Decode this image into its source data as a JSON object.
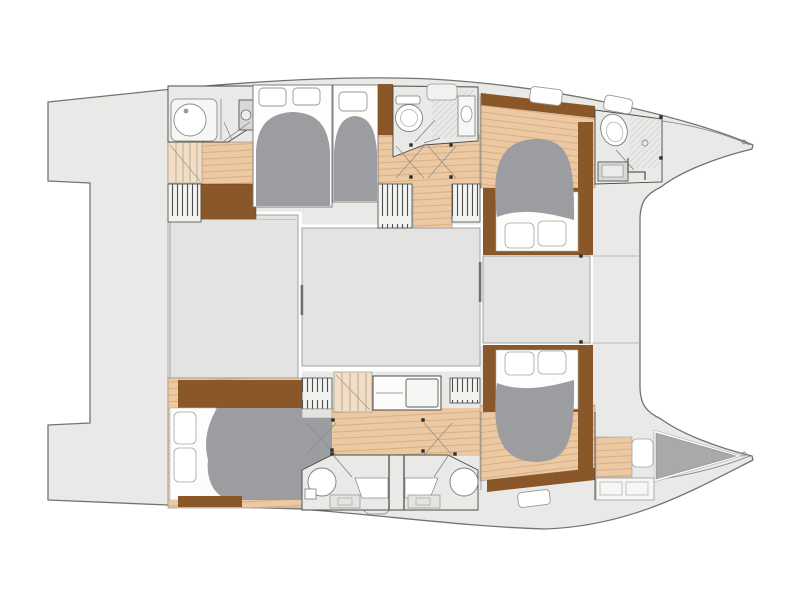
{
  "figure": {
    "type": "floorplan",
    "subject": "catamaran yacht deck plan, top-down view, bow to the right",
    "hulls": 2,
    "cabins": [
      "port-aft-guest-cabin",
      "port-mid-guest-cabin",
      "port-forward-cabin",
      "starboard-aft-cabin",
      "starboard-forward-cabin",
      "bow-crew-berth"
    ],
    "bathrooms": [
      "port-aft-head",
      "port-mid-head",
      "port-forward-head",
      "starboard-aft-head",
      "starboard-forward-head"
    ],
    "common_areas": [
      "aft-cockpit",
      "saloon",
      "forward-cockpit",
      "bow-trampoline",
      "transom-platforms"
    ]
  },
  "palette": {
    "bg": "#ffffff",
    "hull": "#e9e9e8",
    "hull-stroke": "#73736f",
    "deck": "#e3e3e2",
    "deck-stroke": "#a2a2a0",
    "room": "#e9e9e8",
    "room-white": "#fdfdfc",
    "wall": "#4a4a46",
    "wood": "#ecc9a3",
    "wood-line": "#d6ab80",
    "wood-dark": "#8a5728",
    "stair": "#f3dec3",
    "duvet": "#9c9da0",
    "berth": "#a9a9a8",
    "fixture": "#f6f6f5",
    "fixture-stroke": "#7d7d7b",
    "window": "#ffffff",
    "window-stroke": "#98989a",
    "stripe": "#4f4f4b",
    "shower-line": "#b5b5b3",
    "dot": "#2e2e2c",
    "counter": "#d8d8d6",
    "gap": "#ffffff"
  }
}
